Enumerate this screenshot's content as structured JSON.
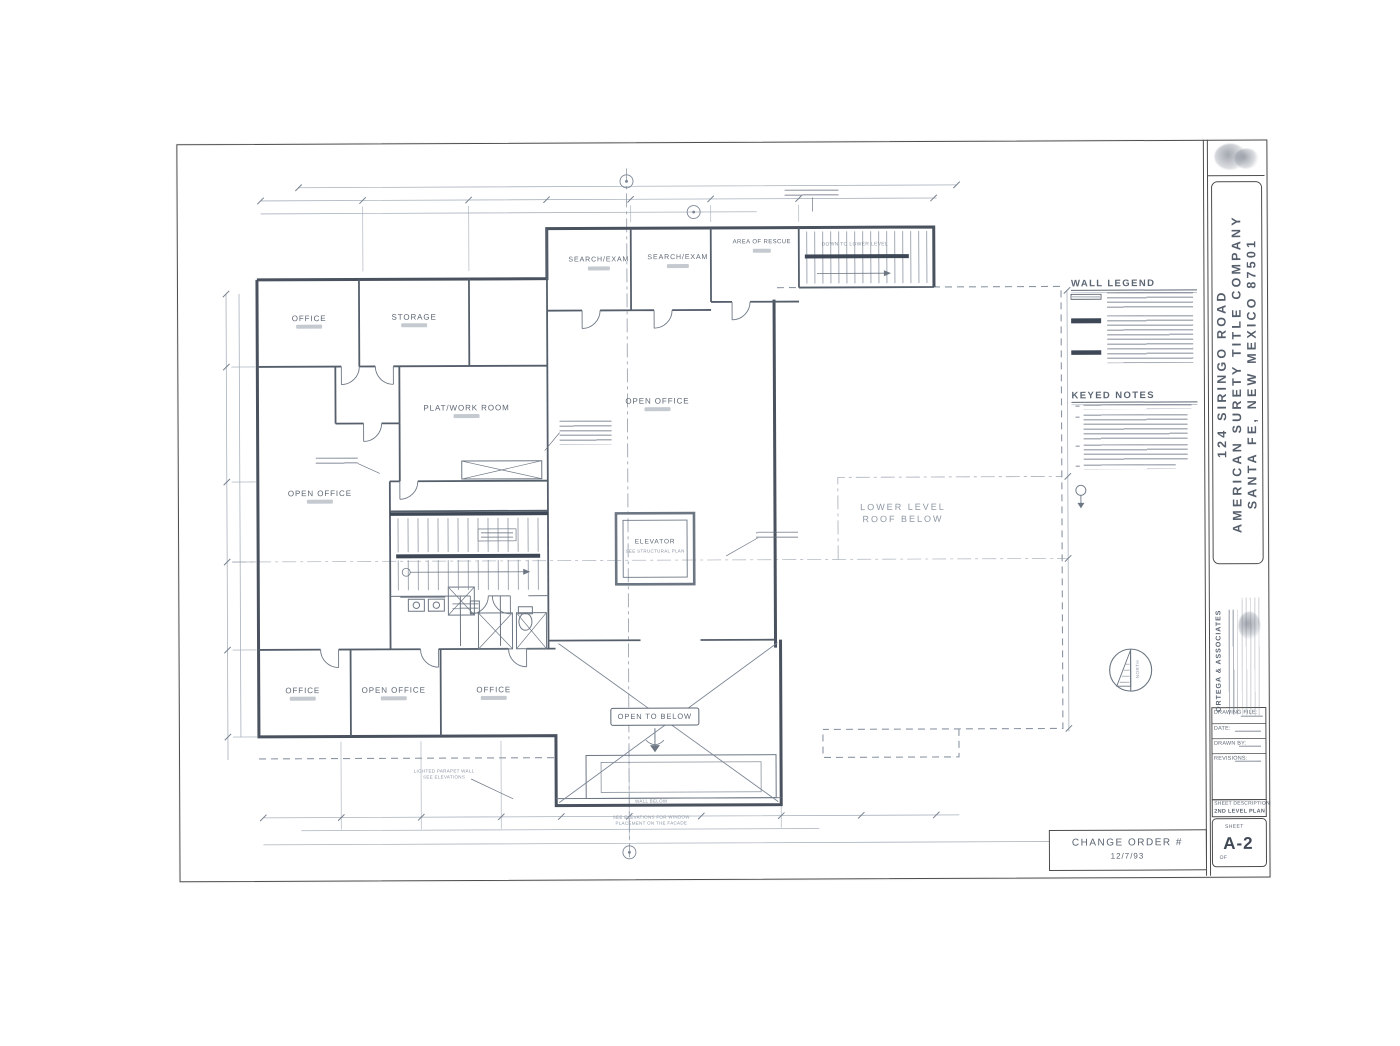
{
  "title_block": {
    "project_lines": [
      "124 SIRINGO ROAD",
      "AMERICAN SURETY TITLE COMPANY",
      "SANTA FE, NEW MEXICO  87501"
    ],
    "architect_name": "ORTEGA & ASSOCIATES",
    "fields": {
      "drawing_file": "DRAWING FILE:",
      "date": "DATE:",
      "drawn_by": "DRAWN BY:",
      "revisions": "REVISIONS:"
    },
    "sheet_description_label": "SHEET DESCRIPTION:",
    "sheet_description_value": "2ND LEVEL PLAN",
    "sheet_word": "SHEET",
    "sheet_number": "A-2",
    "of_word": "OF"
  },
  "plan": {
    "legend_title": "WALL LEGEND",
    "keyed_notes_title": "KEYED NOTES",
    "rooms": {
      "office_tl": "OFFICE",
      "storage": "STORAGE",
      "platwork": "PLAT/WORK ROOM",
      "open_office_left": "OPEN OFFICE",
      "search_exam_1": "SEARCH/EXAM",
      "search_exam_2": "SEARCH/EXAM",
      "area_of_rescue": "AREA OF RESCUE",
      "open_office_center": "OPEN OFFICE",
      "elevator": "ELEVATOR",
      "elevator_sub": "SEE STRUCTURAL PLAN",
      "office_bl": "OFFICE",
      "open_office_bottom": "OPEN OFFICE",
      "office_bm": "OFFICE",
      "open_to_below": "OPEN TO BELOW",
      "down_to_lower": "DOWN TO LOWER LEVEL",
      "roof_line1": "LOWER LEVEL",
      "roof_line2": "ROOF BELOW"
    },
    "notes": {
      "parapet_1": "LIGHTED PARAPET WALL",
      "parapet_2": "SEE ELEVATIONS",
      "wall_below": "WALL BELOW",
      "window_note_1": "SEE ELEVATIONS FOR WINDOW",
      "window_note_2": "PLACEMENT ON THE FACADE",
      "north": "NORTH"
    }
  },
  "change_order": {
    "line1": "CHANGE ORDER #",
    "line2": "12/7/93"
  },
  "colors": {
    "wall": "#49525e",
    "line": "#6d7784",
    "dim": "#a3adb9",
    "text": "#5d6774"
  }
}
